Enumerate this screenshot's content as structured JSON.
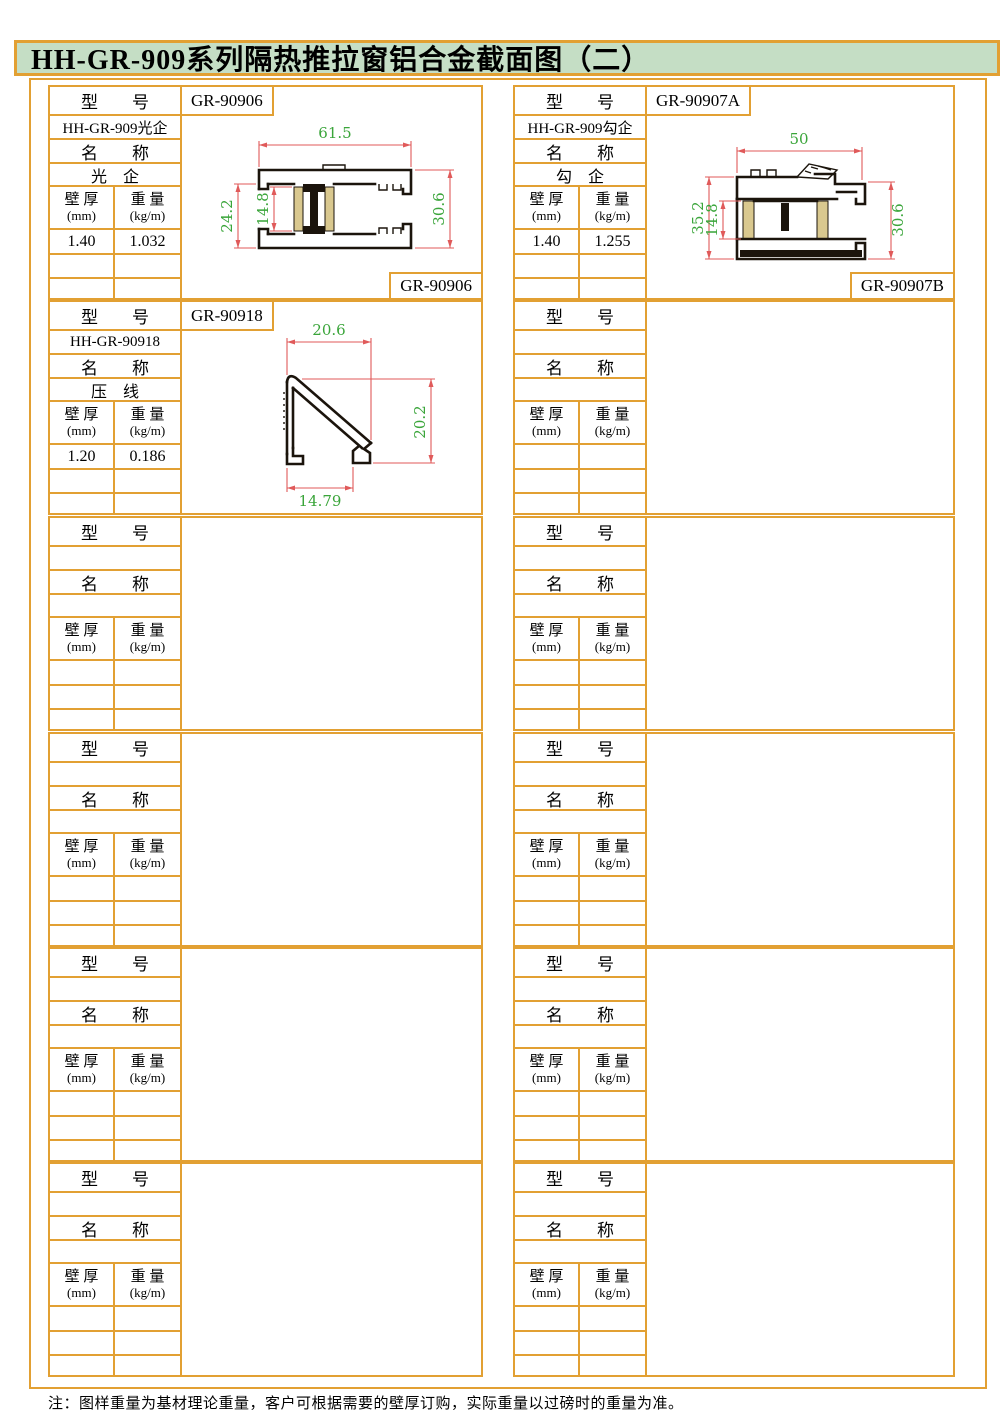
{
  "page": {
    "title": "HH-GR-909系列隔热推拉窗铝合金截面图（二）",
    "footnote": "注：图样重量为基材理论重量，客户可根据需要的壁厚订购，实际重量以过磅时的重量为准。"
  },
  "colors": {
    "border_orange": "#E2A033",
    "title_green": "#C5DEC5",
    "dimension_line_red": "#E05A5A",
    "dimension_text_green": "#3AA53A",
    "thermal_strip_tan": "#D9C88F"
  },
  "table_labels": {
    "model": "型　　号",
    "name": "名　　称",
    "wall": "壁 厚",
    "wall_unit": "(mm)",
    "weight": "重 量",
    "weight_unit": "(kg/m)"
  },
  "columns": [
    {
      "blocks": [
        {
          "tag": "GR-90906",
          "model": "HH-GR-909光企",
          "name": "光　企",
          "wall": "1.40",
          "weight": "1.032",
          "corner_label": "GR-90906",
          "drawing": {
            "type": "thermal-break sliding rail section",
            "dims": {
              "width": "61.5",
              "left_height": "24.2",
              "insulation": "14.8",
              "height": "30.6"
            }
          }
        },
        {
          "tag": "GR-90918",
          "model": "HH-GR-90918",
          "name": "压　线",
          "wall": "1.20",
          "weight": "0.186",
          "corner_label": "",
          "drawing": {
            "type": "glazing bead section",
            "dims": {
              "width": "20.6",
              "height": "20.2",
              "bottom": "14.79"
            }
          }
        },
        {
          "tag": "",
          "model": "",
          "name": "",
          "wall": "",
          "weight": "",
          "corner_label": ""
        },
        {
          "tag": "",
          "model": "",
          "name": "",
          "wall": "",
          "weight": "",
          "corner_label": ""
        },
        {
          "tag": "",
          "model": "",
          "name": "",
          "wall": "",
          "weight": "",
          "corner_label": ""
        },
        {
          "tag": "",
          "model": "",
          "name": "",
          "wall": "",
          "weight": "",
          "corner_label": ""
        }
      ]
    },
    {
      "blocks": [
        {
          "tag": "GR-90907A",
          "model": "HH-GR-909勾企",
          "name": "勾　企",
          "wall": "1.40",
          "weight": "1.255",
          "corner_label": "GR-90907B",
          "drawing": {
            "type": "thermal-break hook rail section",
            "dims": {
              "width": "50",
              "left_height": "35.2",
              "insulation": "14.8",
              "height": "30.6"
            }
          }
        },
        {
          "tag": "",
          "model": "",
          "name": "",
          "wall": "",
          "weight": "",
          "corner_label": ""
        },
        {
          "tag": "",
          "model": "",
          "name": "",
          "wall": "",
          "weight": "",
          "corner_label": ""
        },
        {
          "tag": "",
          "model": "",
          "name": "",
          "wall": "",
          "weight": "",
          "corner_label": ""
        },
        {
          "tag": "",
          "model": "",
          "name": "",
          "wall": "",
          "weight": "",
          "corner_label": ""
        },
        {
          "tag": "",
          "model": "",
          "name": "",
          "wall": "",
          "weight": "",
          "corner_label": ""
        }
      ]
    }
  ]
}
